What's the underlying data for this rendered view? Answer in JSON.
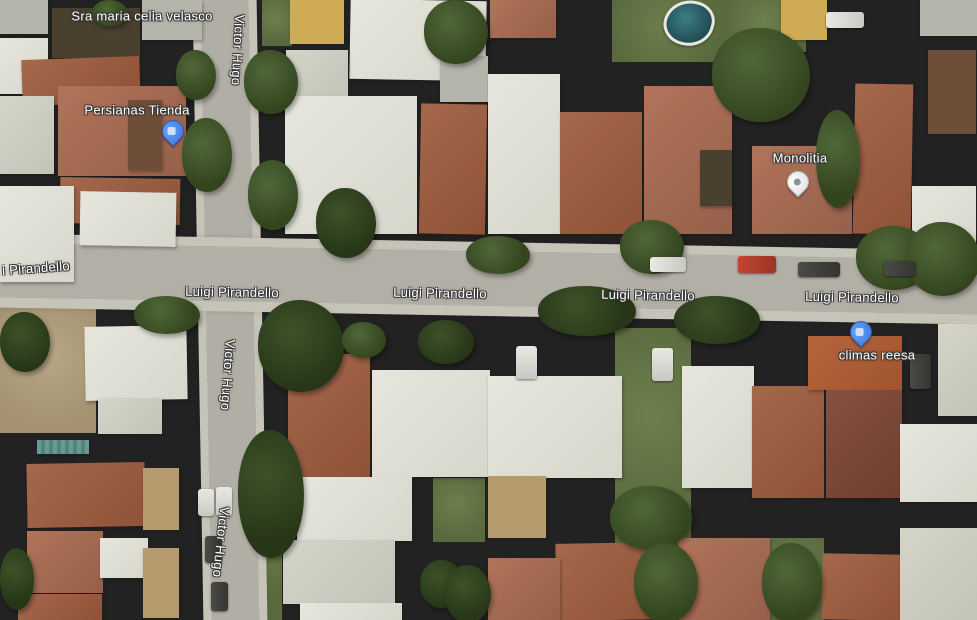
{
  "map": {
    "streets": {
      "luigi_pirandello": "Luigi Pirandello",
      "luigi_pirandello_partial": "i Pirandello",
      "victor_hugo": "Victor Hugo"
    },
    "places": {
      "velasco": "Sra maria celia velasco",
      "persianas": "Persianas Tienda",
      "monolitia": "Monolitia",
      "climas": "climas reesa"
    },
    "pins": {
      "persianas_color": "#4285f4",
      "monolitia_color": "#e8eaed",
      "climas_color": "#4285f4"
    },
    "colors": {
      "label_text": "#ffffff",
      "road": "#b2b0a6",
      "sidewalk": "#c6c4b8",
      "roof_terracotta": "#9c5f44",
      "roof_white": "#e1e1d8",
      "vegetation": "#44582f",
      "pool_water": "#2f6b75"
    }
  }
}
